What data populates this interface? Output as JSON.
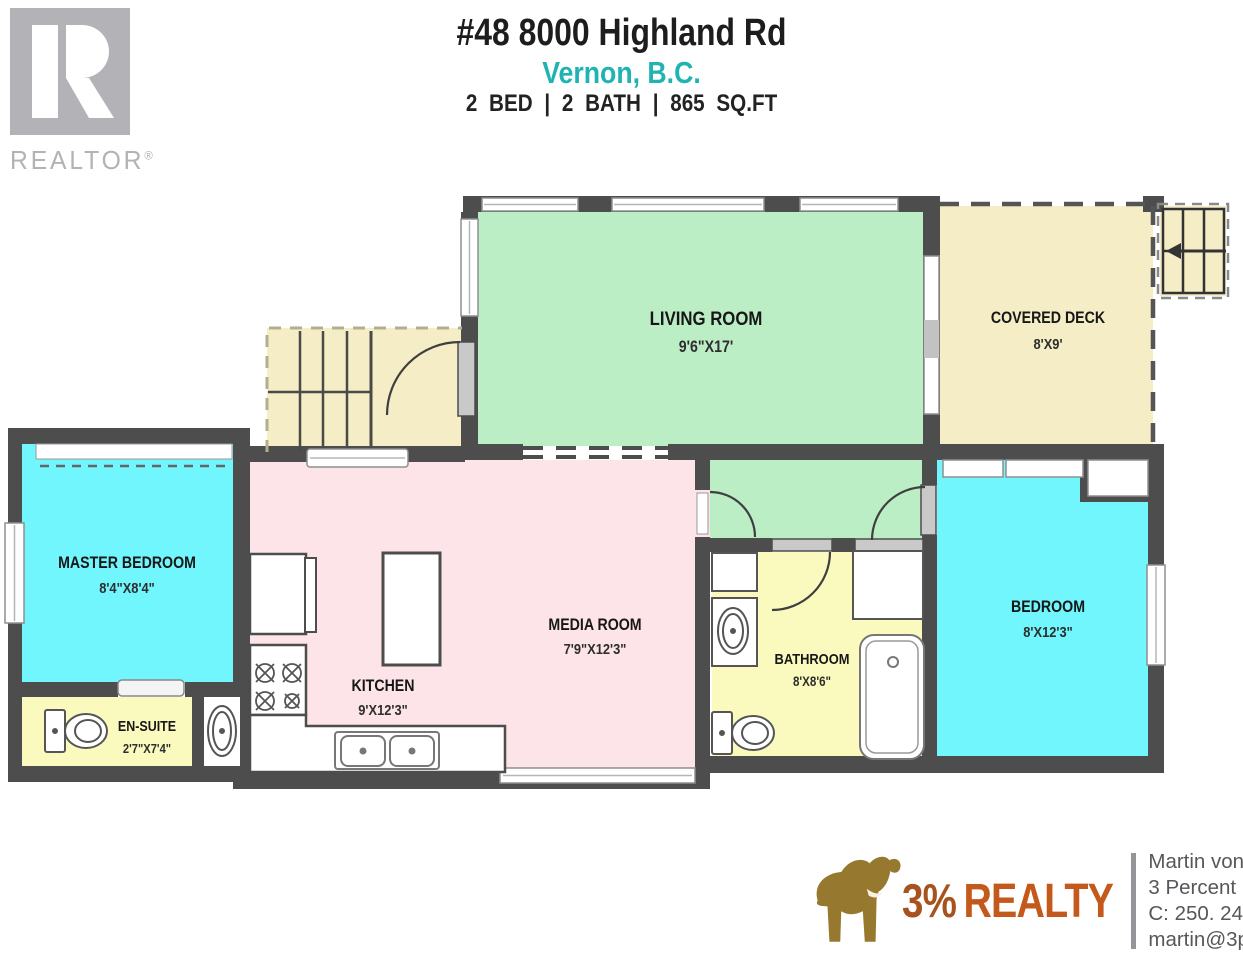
{
  "header": {
    "address": "#48 8000 Highland Rd",
    "city": "Vernon, B.C.",
    "specs": "2 BED | 2 BATH | 865 SQ.FT"
  },
  "realtor_logo": {
    "text": "REALTOR",
    "reg": "®"
  },
  "floorplan": {
    "rooms": {
      "living_room": {
        "name": "LIVING ROOM",
        "dims": "9'6\"X17'"
      },
      "covered_deck": {
        "name": "COVERED DECK",
        "dims": "8'X9'"
      },
      "master_bedroom": {
        "name": "MASTER BEDROOM",
        "dims": "8'4\"X8'4\""
      },
      "en_suite": {
        "name": "EN-SUITE",
        "dims": "2'7\"X7'4\""
      },
      "kitchen": {
        "name": "KITCHEN",
        "dims": "9'X12'3\""
      },
      "media_room": {
        "name": "MEDIA ROOM",
        "dims": "7'9\"X12'3\""
      },
      "bathroom": {
        "name": "BATHROOM",
        "dims": "8'X8'6\""
      },
      "bedroom": {
        "name": "BEDROOM",
        "dims": "8'X12'3\""
      }
    },
    "colors": {
      "wall": "#4d4d4d",
      "living_green": "#bceec6",
      "bedroom_cyan": "#70f6fc",
      "kitchen_pink": "#fce4e8",
      "bath_yellow": "#fafabe",
      "deck_beige": "#f4edc5"
    }
  },
  "footer": {
    "brand": {
      "percent": "3%",
      "realty": "REALTY",
      "color": "#c3591b",
      "elephant_gold": "#97782f"
    },
    "agent": {
      "name": "Martin von Holst",
      "company": "3 Percent Realty Inc.",
      "phone": "C: 250. 241. 5000",
      "email": "martin@3pr.ca"
    }
  }
}
